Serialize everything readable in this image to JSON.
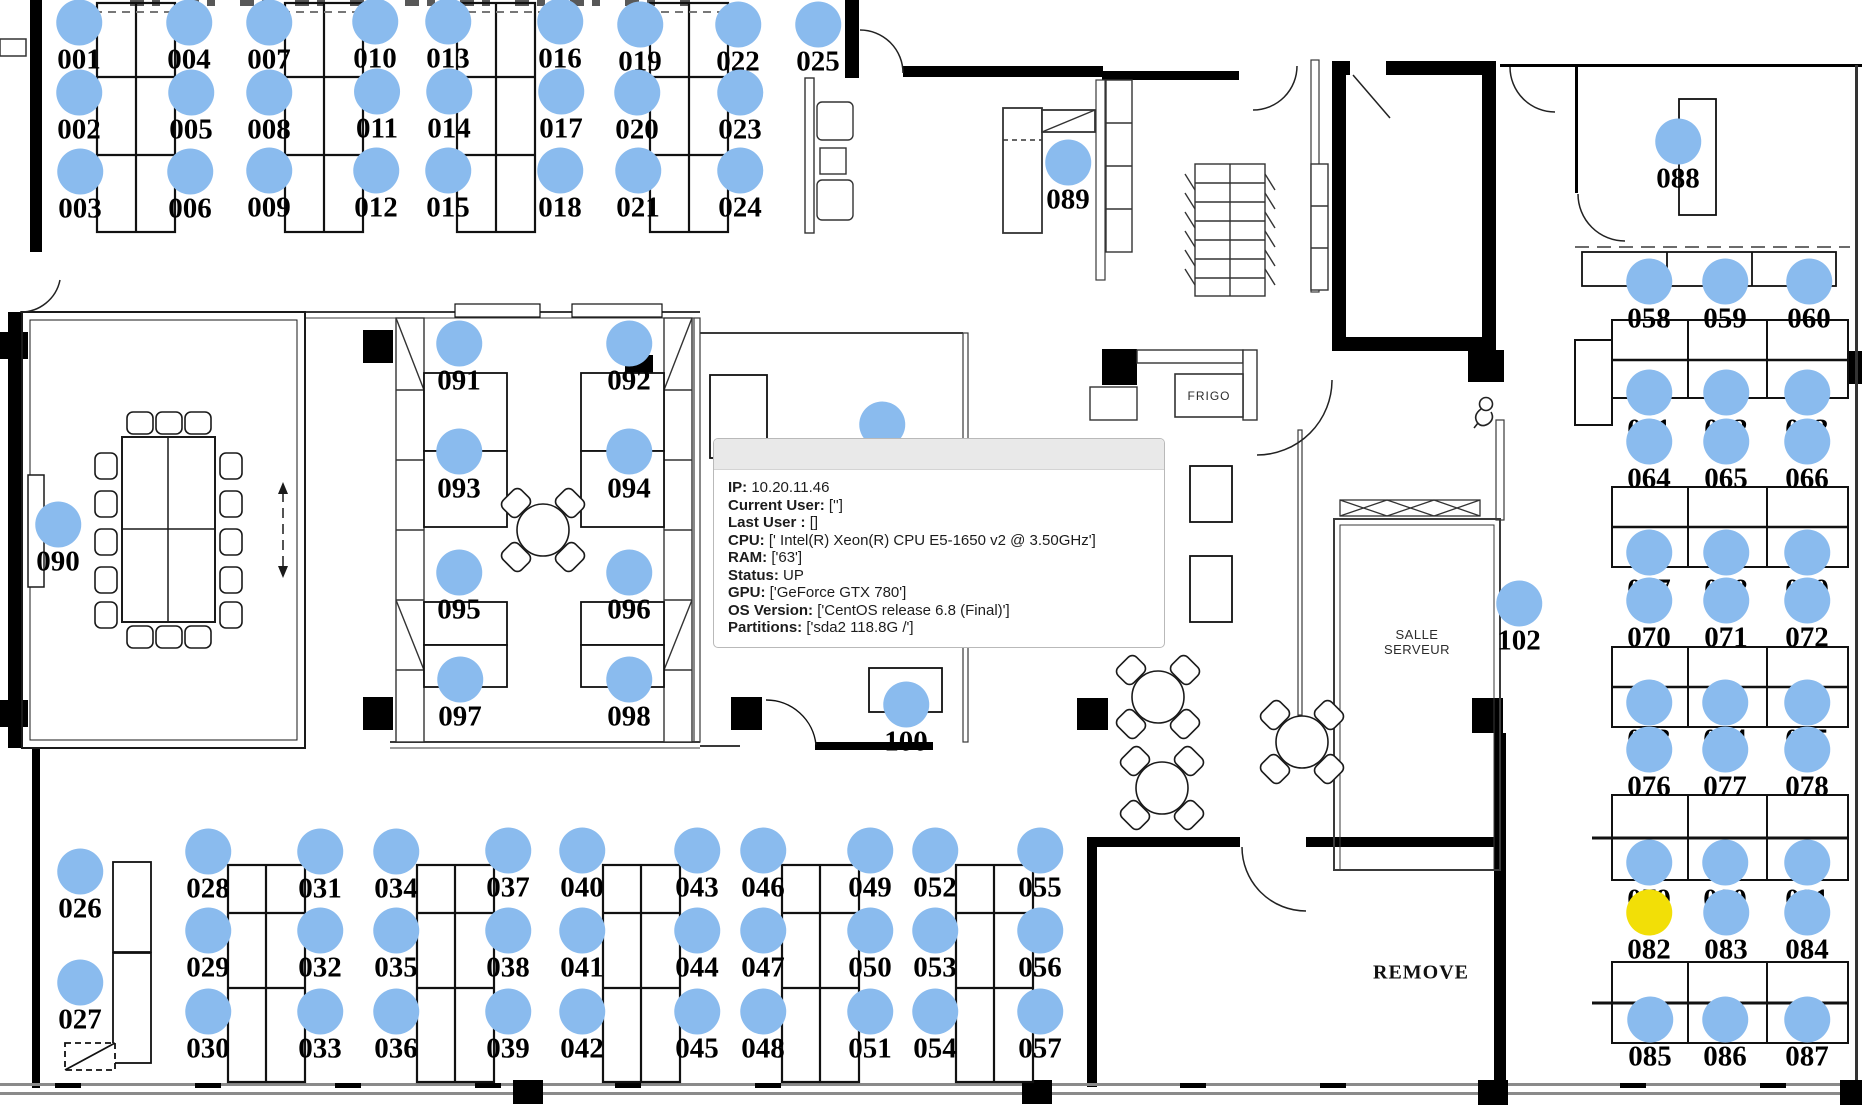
{
  "app": {
    "description": "office floorplan seat map"
  },
  "colors": {
    "seat_default": "#8ABBEE",
    "seat_highlight": "#F2DF07",
    "wall": "#000000",
    "tooltip_header": "#e9e9e9"
  },
  "tooltip": {
    "rows": [
      {
        "label": "IP:",
        "value": " 10.20.11.46"
      },
      {
        "label": "Current User:",
        "value": " ['']"
      },
      {
        "label": "Last User :",
        "value": " []"
      },
      {
        "label": "CPU:",
        "value": " [' Intel(R) Xeon(R) CPU E5-1650 v2 @ 3.50GHz']"
      },
      {
        "label": "RAM:",
        "value": " ['63']"
      },
      {
        "label": "Status:",
        "value": " UP"
      },
      {
        "label": "GPU:",
        "value": " ['GeForce GTX 780']"
      },
      {
        "label": "OS Version:",
        "value": " ['CentOS release 6.8 (Final)']"
      },
      {
        "label": "Partitions:",
        "value": " ['sda2 118.8G /']"
      }
    ]
  },
  "room_labels": {
    "frigo": "FRIGO",
    "salle_serveur_line1": "SALLE",
    "salle_serveur_line2": "SERVEUR",
    "remove": "REMOVE"
  },
  "seats": [
    {
      "id": "001",
      "x": 79,
      "y": 60
    },
    {
      "id": "002",
      "x": 79,
      "y": 130
    },
    {
      "id": "003",
      "x": 80,
      "y": 209
    },
    {
      "id": "004",
      "x": 189,
      "y": 60
    },
    {
      "id": "005",
      "x": 191,
      "y": 130
    },
    {
      "id": "006",
      "x": 190,
      "y": 209
    },
    {
      "id": "007",
      "x": 269,
      "y": 60
    },
    {
      "id": "008",
      "x": 269,
      "y": 130
    },
    {
      "id": "009",
      "x": 269,
      "y": 208
    },
    {
      "id": "010",
      "x": 375,
      "y": 59
    },
    {
      "id": "011",
      "x": 377,
      "y": 129
    },
    {
      "id": "012",
      "x": 376,
      "y": 208
    },
    {
      "id": "013",
      "x": 448,
      "y": 59
    },
    {
      "id": "014",
      "x": 449,
      "y": 129
    },
    {
      "id": "015",
      "x": 448,
      "y": 208
    },
    {
      "id": "016",
      "x": 560,
      "y": 59
    },
    {
      "id": "017",
      "x": 561,
      "y": 129
    },
    {
      "id": "018",
      "x": 560,
      "y": 208
    },
    {
      "id": "019",
      "x": 640,
      "y": 62
    },
    {
      "id": "020",
      "x": 637,
      "y": 130
    },
    {
      "id": "021",
      "x": 638,
      "y": 208
    },
    {
      "id": "022",
      "x": 738,
      "y": 62
    },
    {
      "id": "023",
      "x": 740,
      "y": 130
    },
    {
      "id": "024",
      "x": 740,
      "y": 208
    },
    {
      "id": "025",
      "x": 818,
      "y": 62
    },
    {
      "id": "026",
      "x": 80,
      "y": 909
    },
    {
      "id": "027",
      "x": 80,
      "y": 1020
    },
    {
      "id": "028",
      "x": 208,
      "y": 889
    },
    {
      "id": "029",
      "x": 208,
      "y": 968
    },
    {
      "id": "030",
      "x": 208,
      "y": 1049
    },
    {
      "id": "031",
      "x": 320,
      "y": 889
    },
    {
      "id": "032",
      "x": 320,
      "y": 968
    },
    {
      "id": "033",
      "x": 320,
      "y": 1049
    },
    {
      "id": "034",
      "x": 396,
      "y": 889
    },
    {
      "id": "035",
      "x": 396,
      "y": 968
    },
    {
      "id": "036",
      "x": 396,
      "y": 1049
    },
    {
      "id": "037",
      "x": 508,
      "y": 888
    },
    {
      "id": "038",
      "x": 508,
      "y": 968
    },
    {
      "id": "039",
      "x": 508,
      "y": 1049
    },
    {
      "id": "040",
      "x": 582,
      "y": 888
    },
    {
      "id": "041",
      "x": 582,
      "y": 968
    },
    {
      "id": "042",
      "x": 582,
      "y": 1049
    },
    {
      "id": "043",
      "x": 697,
      "y": 888
    },
    {
      "id": "044",
      "x": 697,
      "y": 968
    },
    {
      "id": "045",
      "x": 697,
      "y": 1049
    },
    {
      "id": "046",
      "x": 763,
      "y": 888
    },
    {
      "id": "047",
      "x": 763,
      "y": 968
    },
    {
      "id": "048",
      "x": 763,
      "y": 1049
    },
    {
      "id": "049",
      "x": 870,
      "y": 888
    },
    {
      "id": "050",
      "x": 870,
      "y": 968
    },
    {
      "id": "051",
      "x": 870,
      "y": 1049
    },
    {
      "id": "052",
      "x": 935,
      "y": 888
    },
    {
      "id": "053",
      "x": 935,
      "y": 968
    },
    {
      "id": "054",
      "x": 935,
      "y": 1049
    },
    {
      "id": "055",
      "x": 1040,
      "y": 888
    },
    {
      "id": "056",
      "x": 1040,
      "y": 968
    },
    {
      "id": "057",
      "x": 1040,
      "y": 1049
    },
    {
      "id": "058",
      "x": 1649,
      "y": 319
    },
    {
      "id": "059",
      "x": 1725,
      "y": 319
    },
    {
      "id": "060",
      "x": 1809,
      "y": 319
    },
    {
      "id": "061",
      "x": 1649,
      "y": 430
    },
    {
      "id": "062",
      "x": 1726,
      "y": 430
    },
    {
      "id": "063",
      "x": 1807,
      "y": 430
    },
    {
      "id": "064",
      "x": 1649,
      "y": 479
    },
    {
      "id": "065",
      "x": 1726,
      "y": 479
    },
    {
      "id": "066",
      "x": 1807,
      "y": 479
    },
    {
      "id": "067",
      "x": 1649,
      "y": 590
    },
    {
      "id": "068",
      "x": 1726,
      "y": 590
    },
    {
      "id": "069",
      "x": 1807,
      "y": 590
    },
    {
      "id": "070",
      "x": 1649,
      "y": 638
    },
    {
      "id": "071",
      "x": 1726,
      "y": 638
    },
    {
      "id": "072",
      "x": 1807,
      "y": 638
    },
    {
      "id": "073",
      "x": 1649,
      "y": 740
    },
    {
      "id": "074",
      "x": 1725,
      "y": 740
    },
    {
      "id": "075",
      "x": 1807,
      "y": 740
    },
    {
      "id": "076",
      "x": 1649,
      "y": 787
    },
    {
      "id": "077",
      "x": 1725,
      "y": 787
    },
    {
      "id": "078",
      "x": 1807,
      "y": 787
    },
    {
      "id": "079",
      "x": 1649,
      "y": 900
    },
    {
      "id": "080",
      "x": 1725,
      "y": 900
    },
    {
      "id": "081",
      "x": 1807,
      "y": 900
    },
    {
      "id": "082",
      "x": 1649,
      "y": 950,
      "highlight": true
    },
    {
      "id": "083",
      "x": 1726,
      "y": 950
    },
    {
      "id": "084",
      "x": 1807,
      "y": 950
    },
    {
      "id": "085",
      "x": 1650,
      "y": 1057
    },
    {
      "id": "086",
      "x": 1725,
      "y": 1057
    },
    {
      "id": "087",
      "x": 1807,
      "y": 1057
    },
    {
      "id": "088",
      "x": 1678,
      "y": 179
    },
    {
      "id": "089",
      "x": 1068,
      "y": 200
    },
    {
      "id": "090",
      "x": 58,
      "y": 562
    },
    {
      "id": "091",
      "x": 459,
      "y": 381
    },
    {
      "id": "092",
      "x": 629,
      "y": 381
    },
    {
      "id": "093",
      "x": 459,
      "y": 489
    },
    {
      "id": "094",
      "x": 629,
      "y": 489
    },
    {
      "id": "095",
      "x": 459,
      "y": 610
    },
    {
      "id": "096",
      "x": 629,
      "y": 610
    },
    {
      "id": "097",
      "x": 460,
      "y": 717
    },
    {
      "id": "098",
      "x": 629,
      "y": 717
    },
    {
      "id": "099",
      "x": 882,
      "y": 462
    },
    {
      "id": "100",
      "x": 906,
      "y": 742
    },
    {
      "id": "102",
      "x": 1519,
      "y": 641
    }
  ]
}
